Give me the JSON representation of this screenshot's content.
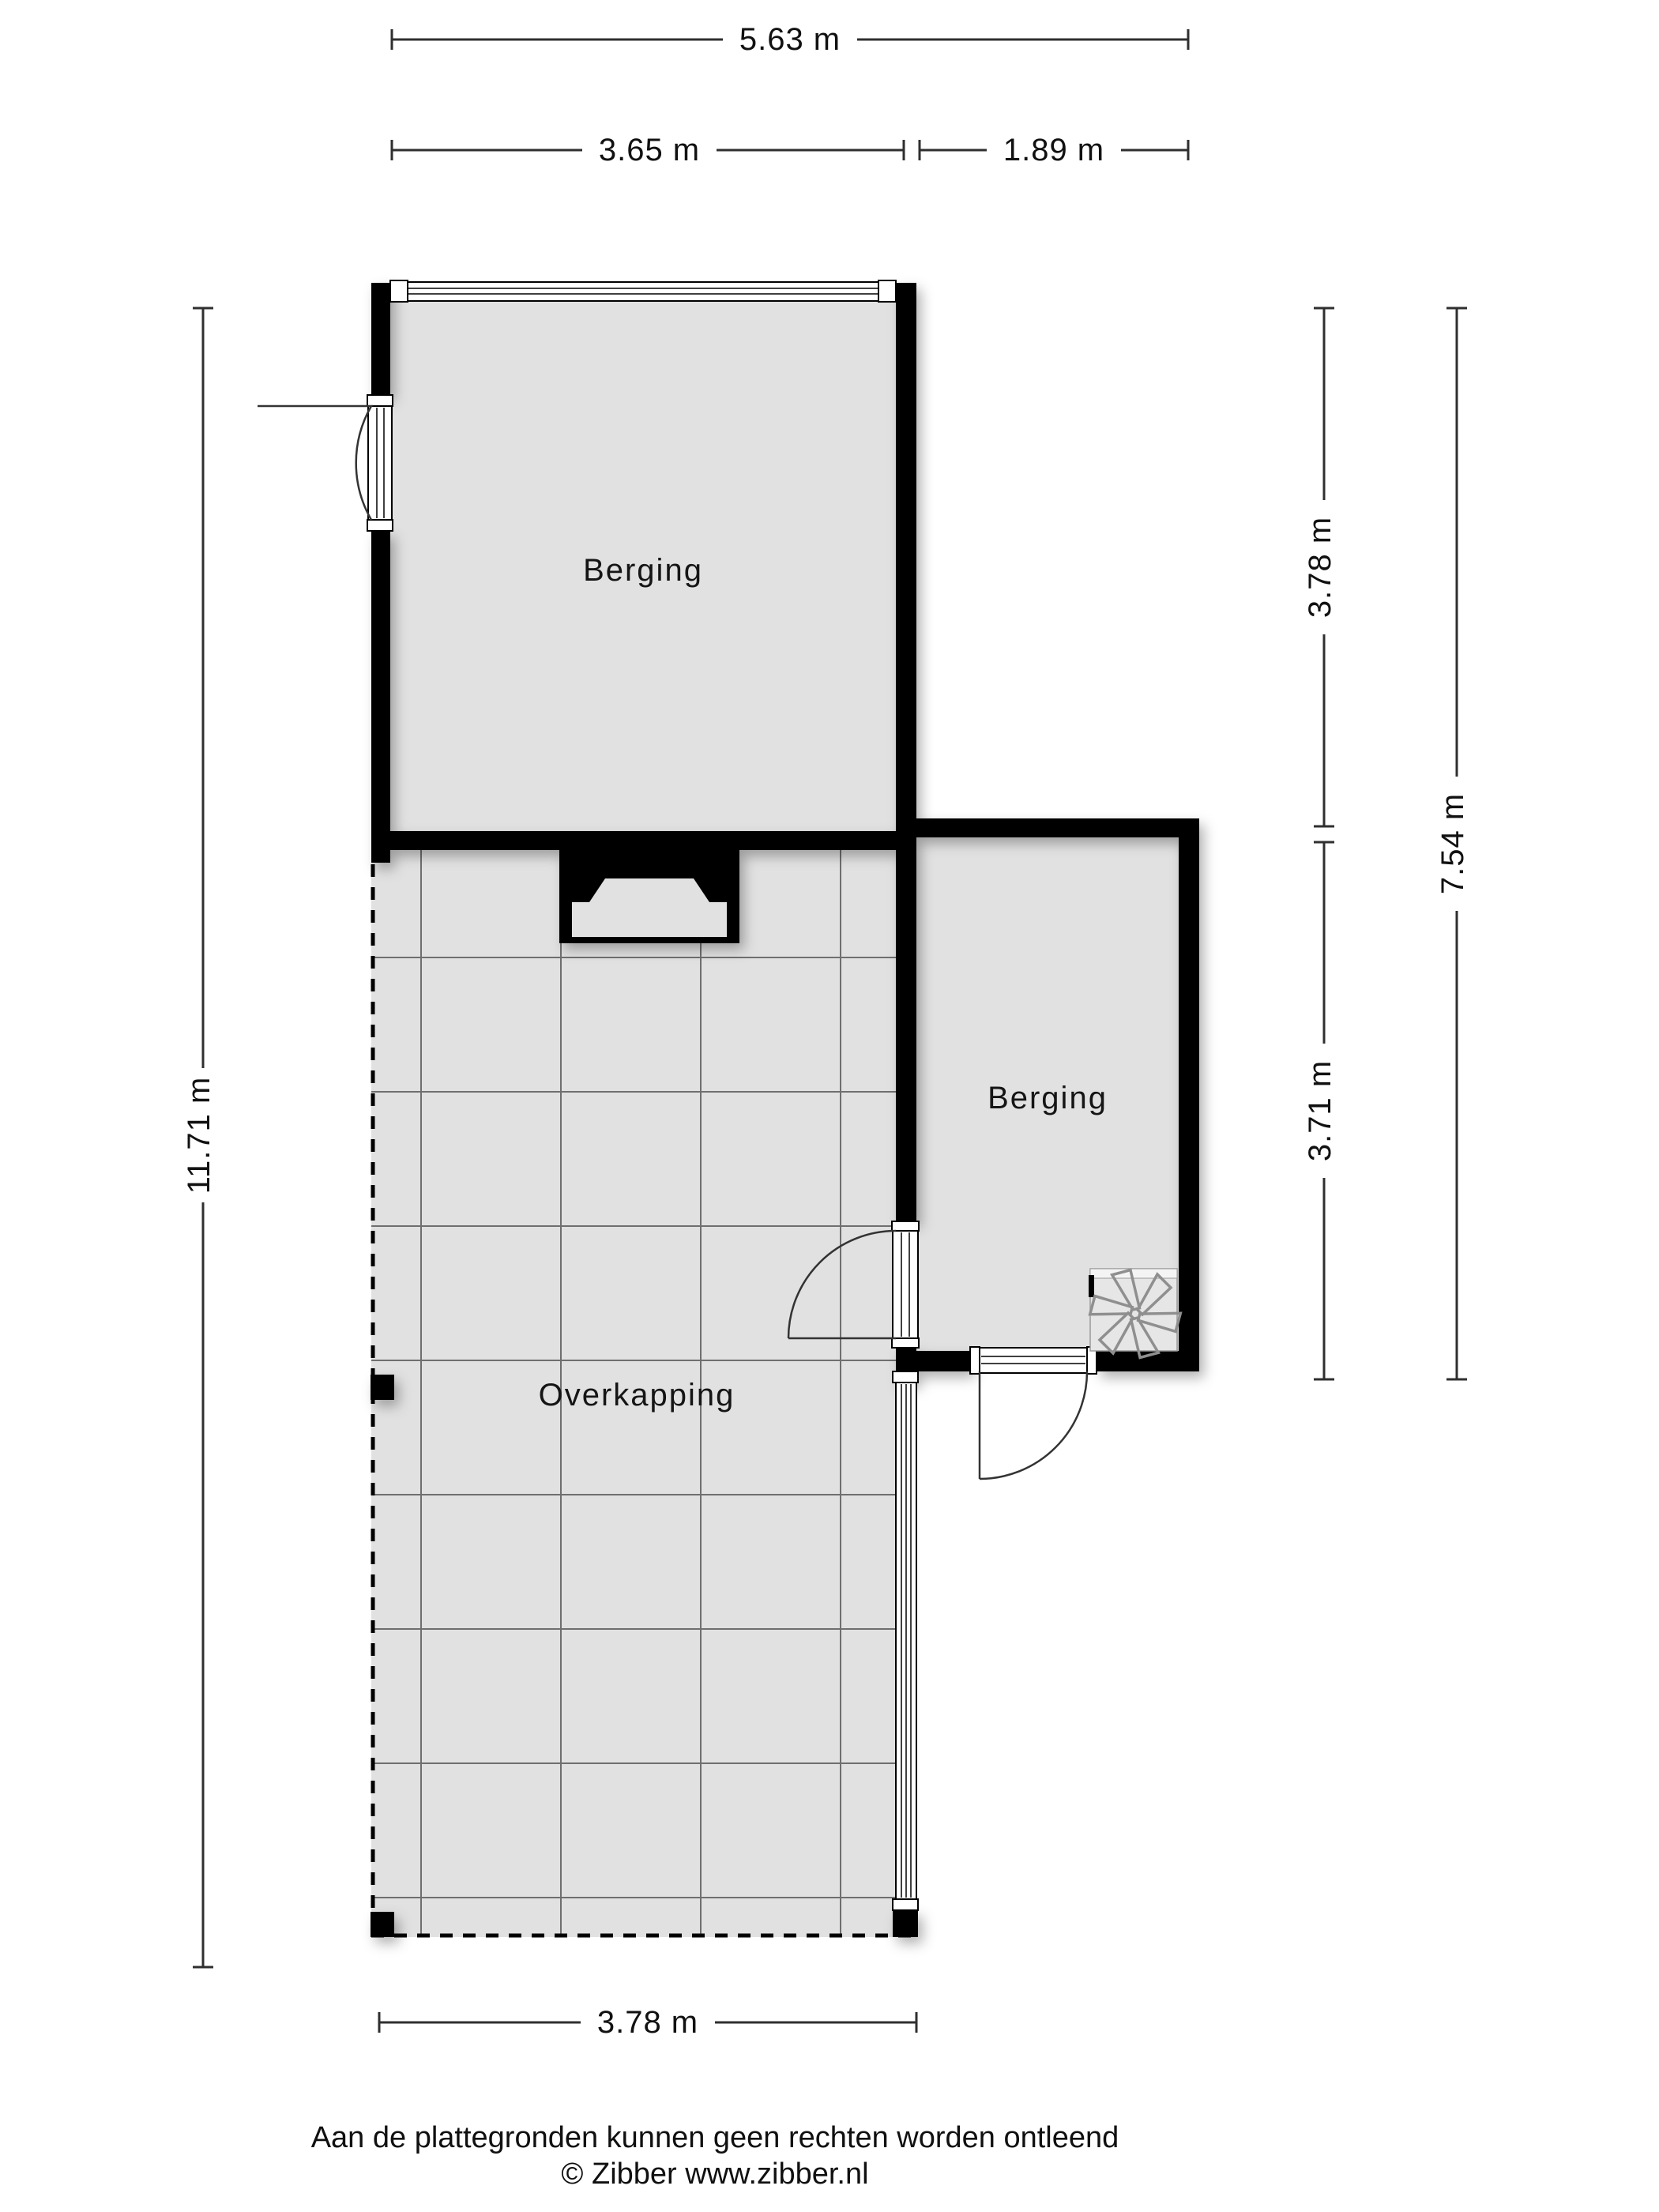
{
  "plan": {
    "rooms": [
      {
        "label": "Berging"
      },
      {
        "label": "Berging"
      },
      {
        "label": "Overkapping"
      }
    ],
    "dimensions": {
      "top_total": "5.63 m",
      "top_segment_left": "3.65 m",
      "top_segment_right": "1.89 m",
      "left_total": "11.71 m",
      "right_upper": "3.78 m",
      "right_lower": "3.71 m",
      "right_total": "7.54 m",
      "bottom": "3.78 m"
    },
    "icons": {
      "fan": "fan-icon"
    },
    "colors": {
      "floor": "#e1e1e1",
      "wall": "#000000",
      "grid": "#6f6f6f",
      "dimension_line": "#2f2f2f",
      "fan_stroke": "#8f8f8f",
      "background": "#ffffff"
    }
  },
  "footer": {
    "disclaimer": "Aan de plattegronden kunnen geen rechten worden ontleend",
    "copyright": "© Zibber www.zibber.nl"
  }
}
